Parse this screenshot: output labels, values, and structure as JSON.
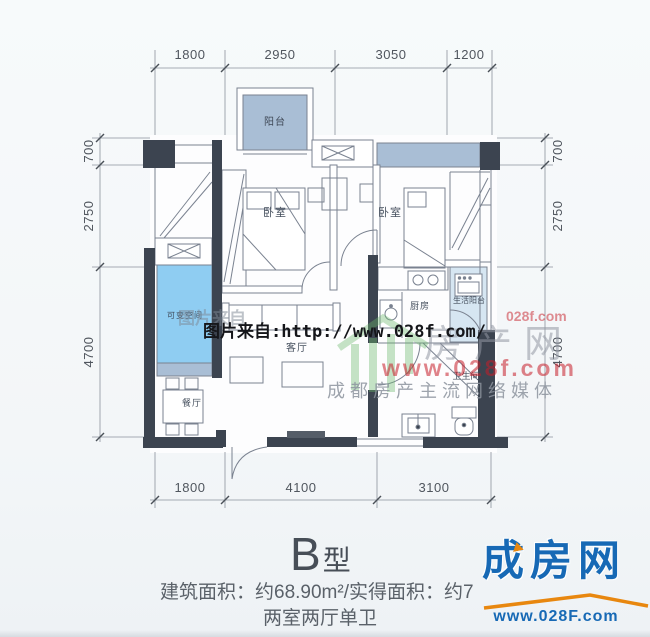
{
  "plan": {
    "dims": {
      "top": [
        "1800",
        "2950",
        "3050",
        "1200"
      ],
      "bottom": [
        "1800",
        "4100",
        "3100"
      ],
      "left": [
        "700",
        "2750",
        "4700"
      ],
      "right": [
        "700",
        "2750",
        "4700"
      ]
    },
    "rooms": {
      "balcony": "阳台",
      "bedroom_left": "卧室",
      "bedroom_right": "卧室",
      "kitchen": "厨房",
      "service_balcony": "生活阳台",
      "flexible_space": "可变空间",
      "living_room": "客厅",
      "dining_room": "餐厅",
      "bathroom": "卫生间"
    }
  },
  "watermarks": {
    "caption": "图片来自:http://www.028f.com/",
    "caption_ghost": "图片来自",
    "site_name_large": "房产网",
    "red_url": "www.028f.com",
    "red_fragment": "028f.com",
    "tagline": "成都房产主流网络媒体"
  },
  "footer": {
    "type_letter": "B",
    "type_suffix": "型",
    "area_line": "建筑面积：约68.90m²/实得面积：约7",
    "layout_line": "两室两厅单卫"
  },
  "logo": {
    "name": "成房网",
    "url": "www.028F.com"
  },
  "colors": {
    "wall": "#3c4450",
    "window_band": "#a9bed5",
    "flexible_fill": "#8fcdf2",
    "service_fill": "#d6e6f2",
    "logo_blue": "#1769b5",
    "logo_orange": "#e8870f",
    "watermark_red": "#c32430"
  }
}
